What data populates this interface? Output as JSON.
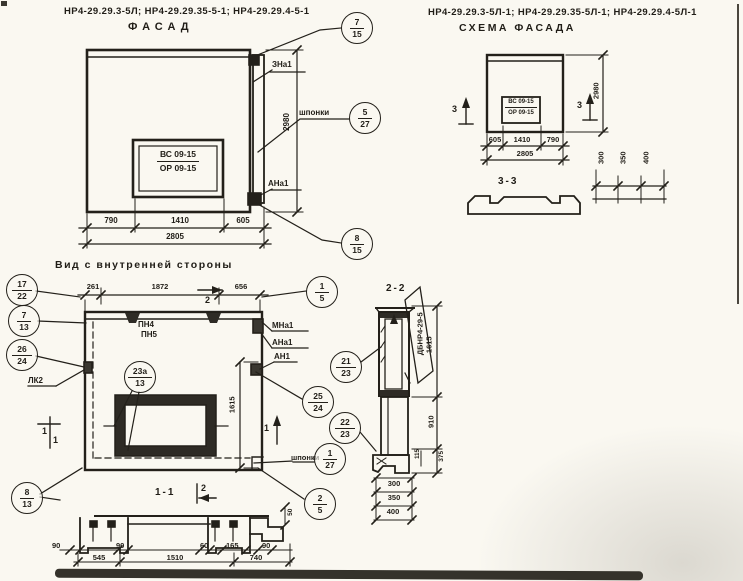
{
  "facade": {
    "code": "НР4-29.29.3-5Л; НР4-29.29.35-5-1; НР4-29.29.4-5-1",
    "title": "ФАСАД",
    "window_mark": {
      "top": "ВС 09-15",
      "bottom": "ОР 09-15"
    },
    "labels": {
      "zna1": "ЗНа1",
      "shponki": "шпонки",
      "ana1": "АНа1"
    },
    "balloons": {
      "top": {
        "num": "7",
        "sheet": "15"
      },
      "shponki": {
        "num": "5",
        "sheet": "27"
      },
      "bottom": {
        "num": "8",
        "sheet": "15"
      }
    },
    "dims": {
      "w1": "790",
      "w2": "1410",
      "w3": "605",
      "total": "2805",
      "height": "2980"
    }
  },
  "scheme": {
    "code": "НР4-29.29.3-5Л-1; НР4-29.29.35-5Л-1; НР4-29.29.4-5Л-1",
    "title": "СХЕМА ФАСАДА",
    "window_mark": {
      "top": "ВС 09-15",
      "bottom": "ОР 09-15"
    },
    "section_marker": "3",
    "dims": {
      "w1": "605",
      "w2": "1410",
      "w3": "790",
      "total": "2805",
      "height": "2980"
    },
    "section33": {
      "title": "3-3",
      "g1": "300",
      "g2": "350",
      "g3": "400"
    }
  },
  "inner": {
    "title": "Вид с внутренней стороны",
    "dims": {
      "t1": "261",
      "t2": "1872",
      "t3": "656",
      "height": "1615"
    },
    "labels": {
      "pn4": "ПН4",
      "pn5": "ПН5",
      "mna1": "МНа1",
      "ana1": "АНа1",
      "an1": "АН1",
      "lk2": "ЛК2",
      "shponki": "шпонки"
    },
    "markers": {
      "m1": "1",
      "m2": "2"
    },
    "balloons": {
      "b15": {
        "num": "1",
        "sheet": "5"
      },
      "b1722": {
        "num": "17",
        "sheet": "22"
      },
      "b713": {
        "num": "7",
        "sheet": "13"
      },
      "b2624": {
        "num": "26",
        "sheet": "24"
      },
      "b813": {
        "num": "8",
        "sheet": "13"
      },
      "b23a13": {
        "num": "23а",
        "sheet": "13"
      },
      "b2123": {
        "num": "21",
        "sheet": "23"
      },
      "b2524": {
        "num": "25",
        "sheet": "24"
      },
      "b2223": {
        "num": "22",
        "sheet": "23"
      },
      "b127": {
        "num": "1",
        "sheet": "27"
      },
      "b25": {
        "num": "2",
        "sheet": "5"
      }
    },
    "section11": {
      "title": "1-1",
      "marker": "2",
      "d1": "90",
      "d2": "545",
      "d3": "90",
      "d4": "1510",
      "d5": "60",
      "d6": "165",
      "d7": "740",
      "d8": "90",
      "d9": "50"
    }
  },
  "section22": {
    "title": "2-2",
    "block_label": "ДБНР4-29-5",
    "dims": {
      "v1": "1615",
      "v2": "910",
      "v3": "375",
      "v4": "115",
      "b1": "300",
      "b2": "350",
      "b3": "400"
    }
  }
}
